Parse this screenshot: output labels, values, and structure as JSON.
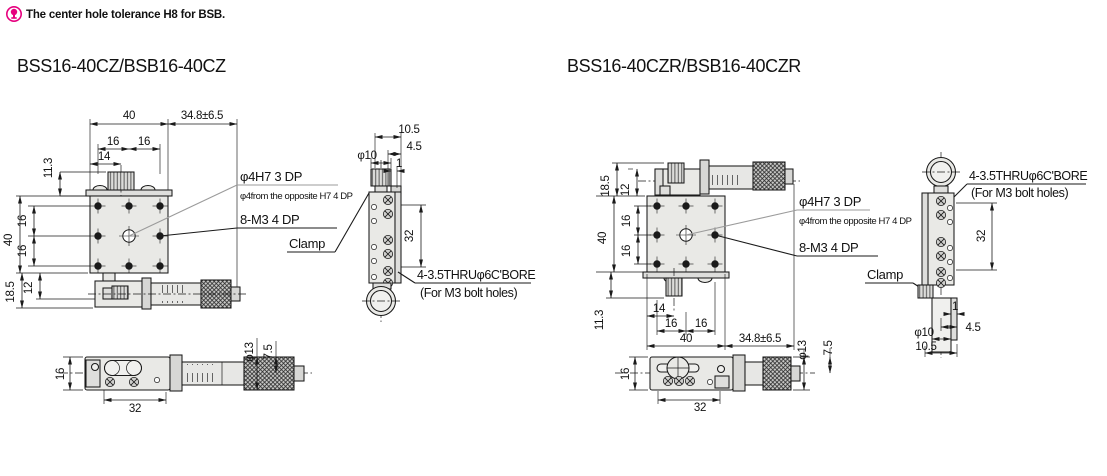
{
  "note": {
    "text": "The center hole tolerance H8 for BSB."
  },
  "colors": {
    "accent": "#e6007e",
    "line": "#1a1a1a",
    "gray": "#9b9b9b"
  },
  "left": {
    "title": "BSS16-40CZ/BSB16-40CZ",
    "front": {
      "w40": "40",
      "travel": "34.8±6.5",
      "s16a": "16",
      "s16b": "16",
      "k14": "14",
      "h11_3": "11.3",
      "v40": "40",
      "v16a": "16",
      "v16b": "16",
      "b18_5": "18.5",
      "b12": "12"
    },
    "callouts": {
      "hole": "φ4H7 3 DP",
      "hole_opp": "φ4from the opposite H7 4 DP",
      "tap": "8-M3 4 DP",
      "clamp": "Clamp"
    },
    "side": {
      "w10_5": "10.5",
      "w4_5": "4.5",
      "w1": "1",
      "knob_dia": "φ10",
      "span": "32",
      "cbore": "4-3.5THRUφ6C'BORE",
      "cbore_sub": "(For M3 bolt holes)"
    },
    "bottom": {
      "h16": "16",
      "span": "32",
      "knob_dia": "φ13",
      "len": "7.5"
    }
  },
  "right": {
    "title": "BSS16-40CZR/BSB16-40CZR",
    "front": {
      "b18_5": "18.5",
      "b12": "12",
      "v40": "40",
      "v16a": "16",
      "v16b": "16",
      "h11_3": "11.3",
      "k14": "14",
      "s16a": "16",
      "s16b": "16",
      "w40": "40",
      "travel": "34.8±6.5"
    },
    "callouts": {
      "hole": "φ4H7 3 DP",
      "hole_opp": "φ4from the opposite H7 4 DP",
      "tap": "8-M3 4 DP",
      "clamp": "Clamp"
    },
    "side": {
      "span": "32",
      "cbore": "4-3.5THRUφ6C'BORE",
      "cbore_sub": "(For M3 bolt holes)",
      "w1": "1",
      "w4_5": "4.5",
      "knob_dia": "φ10",
      "w10_5": "10.5"
    },
    "bottom": {
      "h16": "16",
      "span": "32",
      "knob_dia": "φ13",
      "len": "7.5"
    }
  }
}
